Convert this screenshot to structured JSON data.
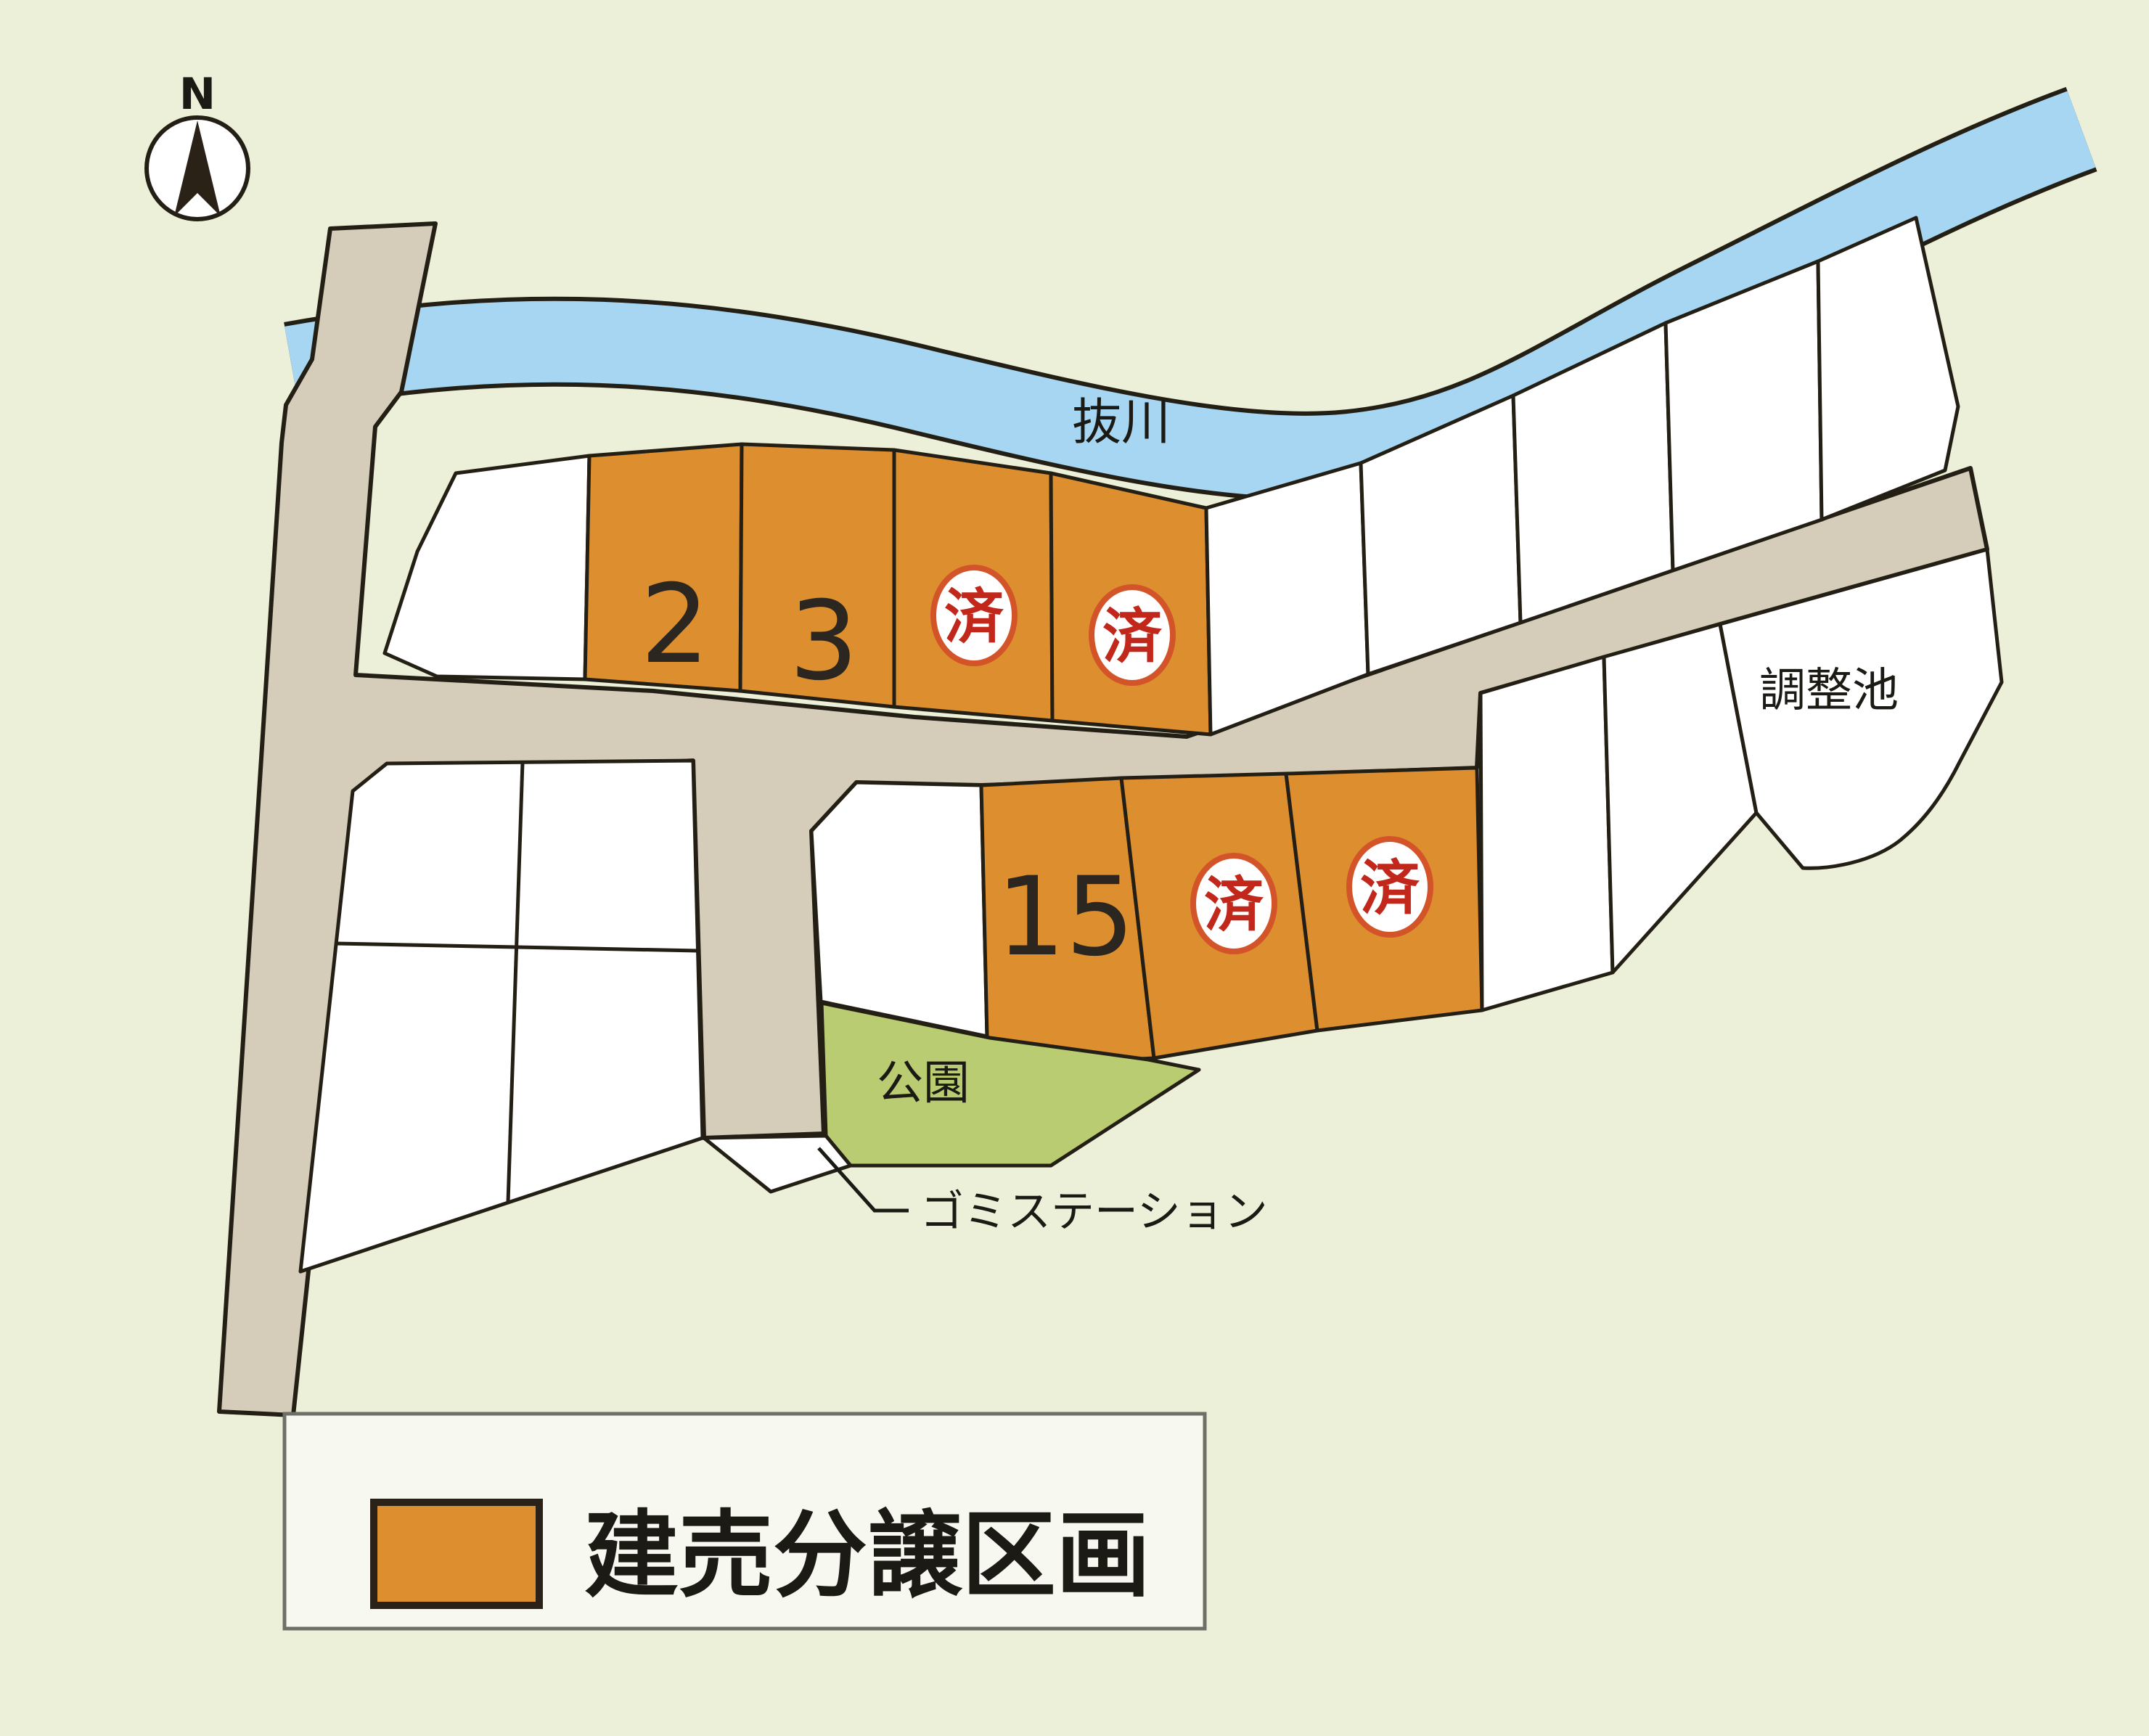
{
  "map": {
    "compass": {
      "label": "N"
    },
    "river": {
      "label": "抜川",
      "color": "#a7d6f2"
    },
    "pond": {
      "label": "調整池"
    },
    "park": {
      "label": "公園",
      "color": "#b9cc71"
    },
    "garbage_station": {
      "label": "ゴミステーション"
    },
    "road_color": "#d5cdb9",
    "background_color": "#edf0d8",
    "lots": {
      "upper_row": [
        {
          "id": "2",
          "label": "2",
          "status": "available"
        },
        {
          "id": "3",
          "label": "3",
          "status": "available"
        },
        {
          "id": "sold-a",
          "label": "済",
          "status": "sold"
        },
        {
          "id": "sold-b",
          "label": "済",
          "status": "sold"
        }
      ],
      "lower_row": [
        {
          "id": "15",
          "label": "15",
          "status": "available"
        },
        {
          "id": "sold-c",
          "label": "済",
          "status": "sold"
        },
        {
          "id": "sold-d",
          "label": "済",
          "status": "sold"
        }
      ],
      "available_color": "#dd8e2e",
      "sold_stamp_color": "#c1271b"
    }
  },
  "legend": {
    "label": "建売分譲区画",
    "swatch_color": "#dd8e2e"
  }
}
